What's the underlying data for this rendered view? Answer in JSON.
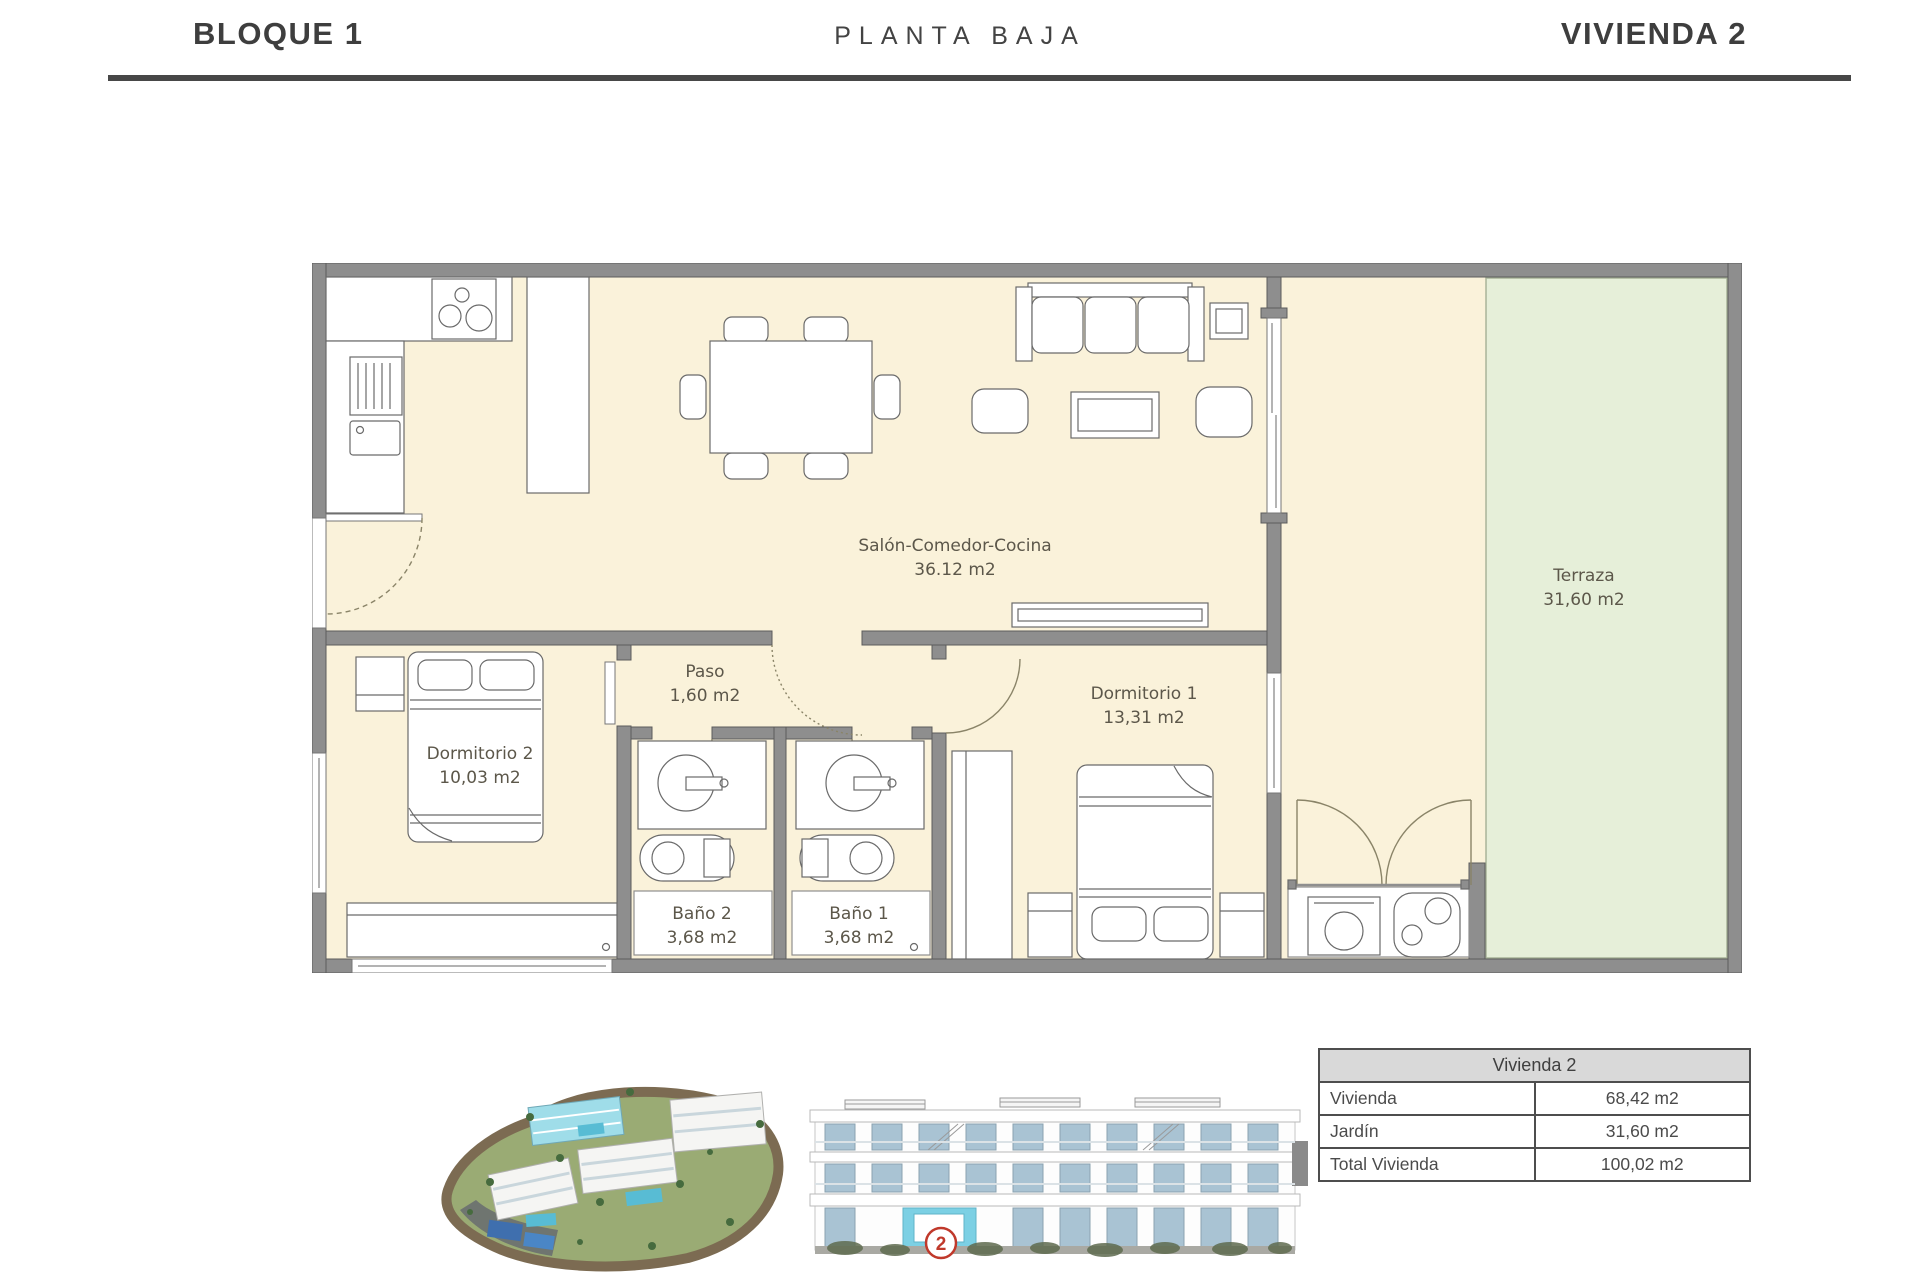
{
  "header": {
    "block": "BLOQUE 1",
    "floor": "PLANTA BAJA",
    "unit": "VIVIENDA 2"
  },
  "plan": {
    "rooms": {
      "salon": {
        "name": "Salón-Comedor-Cocina",
        "area": "36.12 m2"
      },
      "paso": {
        "name": "Paso",
        "area": "1,60 m2"
      },
      "dormitorio2": {
        "name": "Dormitorio 2",
        "area": "10,03 m2"
      },
      "dormitorio1": {
        "name": "Dormitorio 1",
        "area": "13,31 m2"
      },
      "bano2": {
        "name": "Baño 2",
        "area": "3,68 m2"
      },
      "bano1": {
        "name": "Baño 1",
        "area": "3,68 m2"
      },
      "terraza": {
        "name": "Terraza",
        "area": "31,60 m2"
      }
    }
  },
  "summary_table": {
    "title": "Vivienda 2",
    "rows": [
      {
        "label": "Vivienda",
        "value": "68,42 m2"
      },
      {
        "label": "Jardín",
        "value": "31,60 m2"
      },
      {
        "label": "Total Vivienda",
        "value": "100,02 m2"
      }
    ]
  },
  "elevation": {
    "unit_badge": "2"
  },
  "colors": {
    "wall": "#8e8e8e",
    "floor_cream": "#faf2da",
    "terrace_green": "#e6efd9",
    "accent_red": "#c0392b",
    "highlight_cyan": "#7cd0e4",
    "table_header_bg": "#d9d9d9",
    "rule": "#474747"
  }
}
